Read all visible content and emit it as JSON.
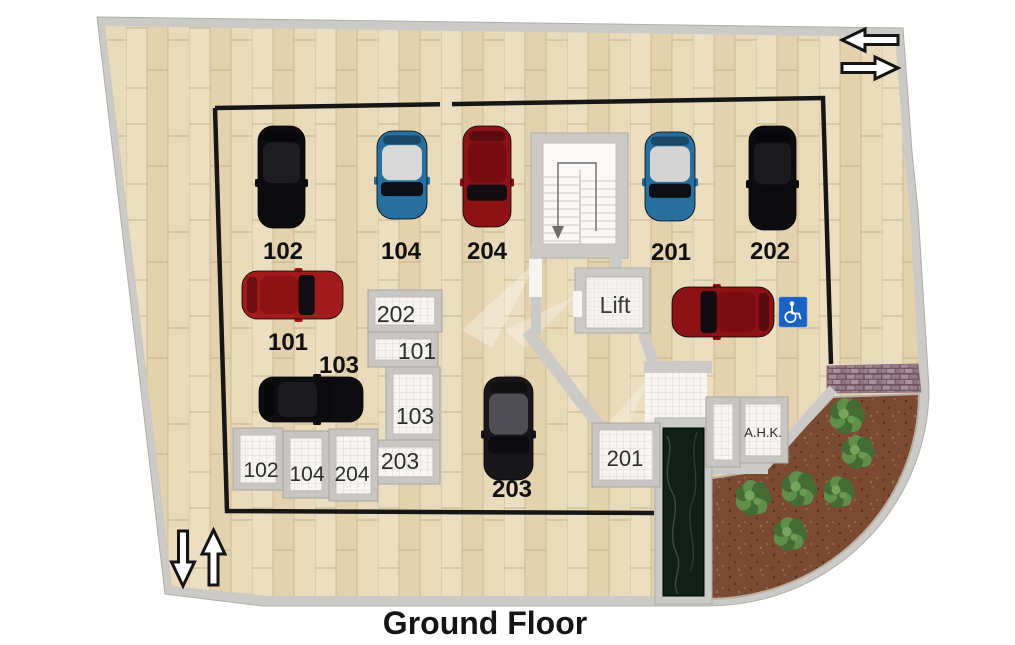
{
  "title": "Ground Floor",
  "lift": {
    "label": "Lift"
  },
  "colors": {
    "wood": "#e7d7b5",
    "wall": "#cbcac7",
    "boundary": "#161616",
    "room_frame": "#c7c6c3",
    "room_floor": "#f8f6f3",
    "dirt": "#7b4a32",
    "bush_green": "#4f7a3c",
    "marble": "#0f2018",
    "brick_tile": "#a68e98",
    "handicap_blue": "#1a63c4",
    "parking_label": "#101010",
    "room_label": "#2e2e2e"
  },
  "parking_spots": [
    {
      "label": "102",
      "lx": 283,
      "ly": 259,
      "car": {
        "body": "#0c0c0e",
        "roof": "#1e1e22",
        "x": 258,
        "y": 126,
        "w": 47,
        "h": 102,
        "dir": "down"
      }
    },
    {
      "label": "104",
      "lx": 401,
      "ly": 259,
      "car": {
        "body": "#276f9f",
        "roof": "#d8d8d8",
        "x": 377,
        "y": 131,
        "w": 50,
        "h": 88,
        "dir": "down"
      }
    },
    {
      "label": "204",
      "lx": 487,
      "ly": 259,
      "car": {
        "body": "#8c1216",
        "roof": "#760b10",
        "x": 463,
        "y": 126,
        "w": 48,
        "h": 101,
        "dir": "down"
      }
    },
    {
      "label": "201",
      "lx": 671,
      "ly": 260,
      "car": {
        "body": "#276f9f",
        "roof": "#d4d4d4",
        "x": 645,
        "y": 132,
        "w": 50,
        "h": 89,
        "dir": "down"
      }
    },
    {
      "label": "202",
      "lx": 770,
      "ly": 259,
      "car": {
        "body": "#0c0c0e",
        "roof": "#1a1a1e",
        "x": 749,
        "y": 126,
        "w": 47,
        "h": 104,
        "dir": "down"
      }
    },
    {
      "label": "101",
      "lx": 288,
      "ly": 350,
      "car": {
        "body": "#a31a1c",
        "roof": "#8e1115",
        "x": 242,
        "y": 271,
        "w": 101,
        "h": 48,
        "dir": "right"
      }
    },
    {
      "label": "103",
      "lx": 339,
      "ly": 373,
      "car": {
        "body": "#0d0d0f",
        "roof": "#1b1b1f",
        "x": 259,
        "y": 377,
        "w": 104,
        "h": 45,
        "dir": "right"
      }
    },
    {
      "label": "203",
      "lx": 512,
      "ly": 497,
      "car": {
        "body": "#17171a",
        "roof": "#4e4e54",
        "x": 484,
        "y": 377,
        "w": 49,
        "h": 103,
        "dir": "down"
      }
    },
    {
      "label": "",
      "lx": 0,
      "ly": 0,
      "car": {
        "body": "#8c1216",
        "roof": "#790c11",
        "x": 672,
        "y": 287,
        "w": 102,
        "h": 50,
        "dir": "left"
      }
    }
  ],
  "storage_rooms": [
    {
      "label": "202",
      "x": 368,
      "y": 290,
      "w": 74,
      "h": 42,
      "lx": 396,
      "ly": 322,
      "fs": 23
    },
    {
      "label": "101",
      "x": 368,
      "y": 332,
      "w": 70,
      "h": 35,
      "lx": 417,
      "ly": 359,
      "fs": 23
    },
    {
      "label": "103",
      "x": 386,
      "y": 367,
      "w": 54,
      "h": 74,
      "lx": 415,
      "ly": 424,
      "fs": 23
    },
    {
      "label": "203",
      "x": 371,
      "y": 440,
      "w": 69,
      "h": 44,
      "lx": 400,
      "ly": 469,
      "fs": 23
    },
    {
      "label": "102",
      "x": 233,
      "y": 428,
      "w": 50,
      "h": 62,
      "lx": 261,
      "ly": 477,
      "fs": 21
    },
    {
      "label": "104",
      "x": 283,
      "y": 431,
      "w": 46,
      "h": 67,
      "lx": 307,
      "ly": 481,
      "fs": 21
    },
    {
      "label": "204",
      "x": 329,
      "y": 429,
      "w": 49,
      "h": 72,
      "lx": 352,
      "ly": 481,
      "fs": 21
    },
    {
      "label": "201",
      "x": 592,
      "y": 423,
      "w": 68,
      "h": 64,
      "lx": 625,
      "ly": 466,
      "fs": 22
    },
    {
      "label": "A.H.K.",
      "x": 738,
      "y": 397,
      "w": 50,
      "h": 66,
      "lx": 763,
      "ly": 437,
      "fs": 13
    },
    {
      "label": "",
      "x": 706,
      "y": 397,
      "w": 34,
      "h": 70,
      "lx": 0,
      "ly": 0,
      "fs": 0
    }
  ],
  "garden": {
    "bushes": [
      {
        "x": 847,
        "y": 416,
        "r": 17
      },
      {
        "x": 858,
        "y": 452,
        "r": 16
      },
      {
        "x": 799,
        "y": 489,
        "r": 17
      },
      {
        "x": 839,
        "y": 492,
        "r": 15
      },
      {
        "x": 753,
        "y": 498,
        "r": 17
      },
      {
        "x": 790,
        "y": 534,
        "r": 16
      }
    ]
  },
  "icons": {
    "entry_exit_top": [
      "arrow-left-icon",
      "arrow-right-icon"
    ],
    "entry_exit_bottom": [
      "arrow-down-icon",
      "arrow-up-icon"
    ],
    "accessible_parking": "wheelchair-icon",
    "stairs_direction": "arrow-down"
  }
}
